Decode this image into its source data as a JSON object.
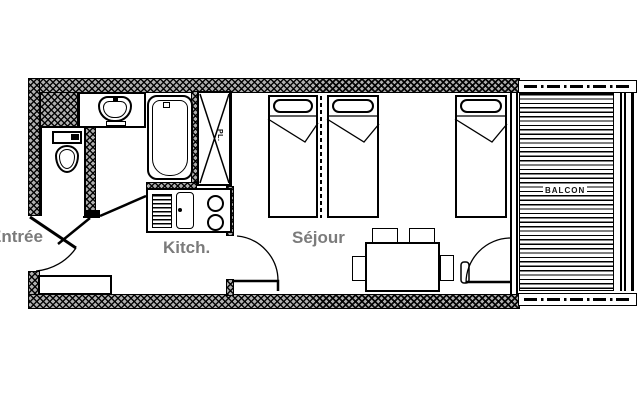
{
  "page": {
    "background": "#ffffff"
  },
  "colors": {
    "line": "#000000",
    "wall_fill": "#b0b0b0",
    "label": "#7b7b7b",
    "balcony_label": "#111111"
  },
  "labels": {
    "entrance": "Entrée",
    "kitchen": "Kitch.",
    "living_room": "Séjour",
    "balcony": "BALCON",
    "closet": "PL."
  },
  "plan": {
    "type": "apartment-floor-plan",
    "visible_room_labels": [
      "Entrée",
      "Kitch.",
      "Séjour",
      "BALCON"
    ],
    "fixture_icons": [
      "toilet-icon",
      "washbasin-icon",
      "bathtub-icon",
      "closet-cross-icon",
      "kitchen-sink-icon",
      "drainer-icon",
      "two-burner-hob-icon",
      "single-bed-icon",
      "single-bed-icon",
      "single-bed-icon",
      "dining-table-icon",
      "chair-icon",
      "entrance-wardrobe-icon",
      "balcony-decking-icon",
      "door-swing-icon"
    ]
  }
}
